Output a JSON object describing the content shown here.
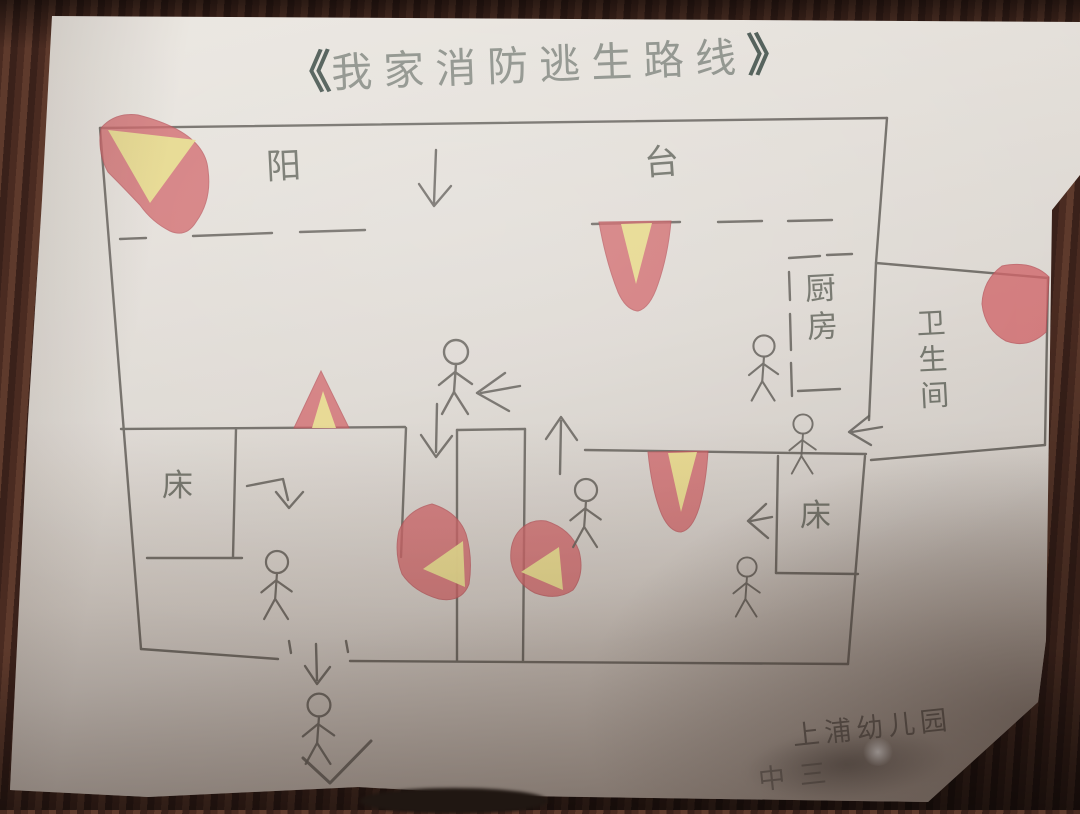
{
  "type": "hand_drawn_child_fire_escape_floor_plan_photo",
  "title": {
    "open": "《",
    "text": "我家消防逃生路线",
    "close": "》"
  },
  "labels": {
    "balcony_left_char": "阳",
    "balcony_right_char": "台",
    "kitchen": "厨房",
    "bathroom": "卫生间",
    "bed_left": "床",
    "bed_right": "床"
  },
  "signature": {
    "school": "上浦幼儿园",
    "class_line": "中三"
  },
  "elements": {
    "stick_figures": 7,
    "flames": 7,
    "route_arrows": 8,
    "beds": 2
  },
  "colors": {
    "flame_red": "#cf5f63",
    "flame_yellow": "#e7df8d",
    "pencil_gray": "#5f5b55",
    "bracket_ink": "#41504a",
    "paper": "#ddd8d2",
    "wood_background": "#43261d"
  }
}
